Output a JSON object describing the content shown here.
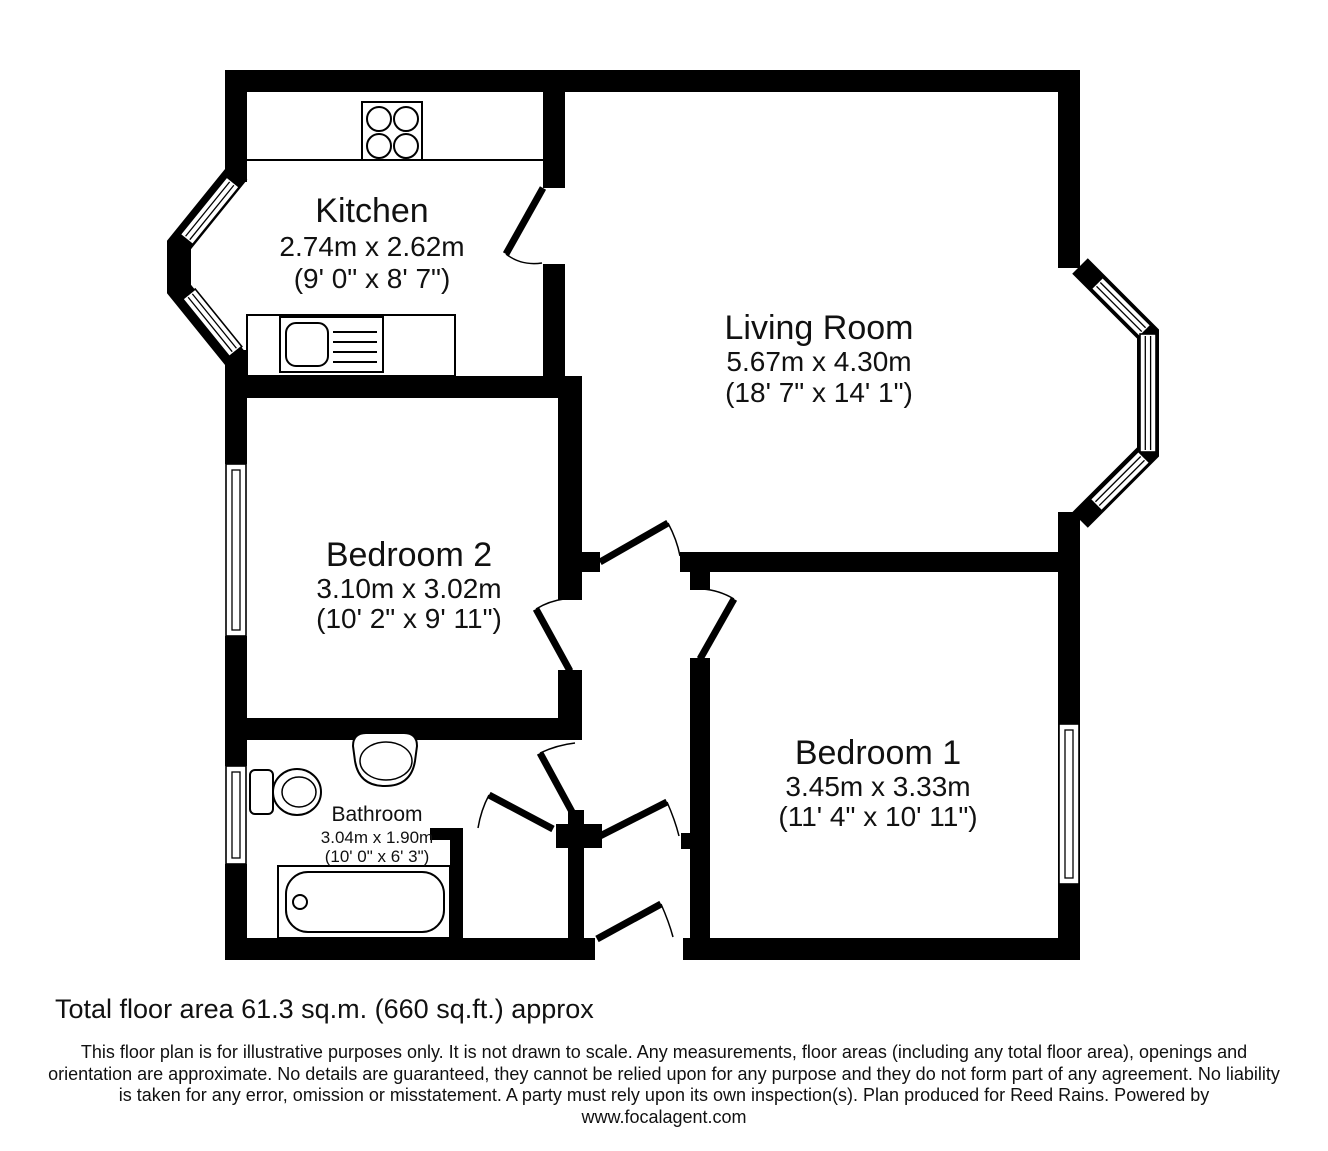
{
  "rooms": {
    "kitchen": {
      "name": "Kitchen",
      "metric": "2.74m x 2.62m",
      "imperial": "(9' 0\" x 8' 7\")"
    },
    "living_room": {
      "name": "Living Room",
      "metric": "5.67m x 4.30m",
      "imperial": "(18' 7\" x 14' 1\")"
    },
    "bedroom2": {
      "name": "Bedroom 2",
      "metric": "3.10m x 3.02m",
      "imperial": "(10' 2\" x 9' 11\")"
    },
    "bedroom1": {
      "name": "Bedroom 1",
      "metric": "3.45m x 3.33m",
      "imperial": "(11' 4\" x 10' 11\")"
    },
    "bathroom": {
      "name": "Bathroom",
      "metric": "3.04m x 1.90m",
      "imperial": "(10' 0\" x 6' 3\")"
    }
  },
  "footer": {
    "total_area": "Total floor area 61.3 sq.m. (660 sq.ft.) approx",
    "disclaimer": "This floor plan is for illustrative purposes only. It is not drawn to scale. Any measurements, floor areas (including any total floor area), openings and orientation are approximate. No details are guaranteed, they cannot be relied upon for any purpose and they do not form part of any agreement. No liability is taken for any error, omission or misstatement. A party must rely upon its own inspection(s). Plan produced for Reed Rains. Powered by",
    "website": "www.focalagent.com"
  },
  "colors": {
    "walls": "#000000",
    "background": "#ffffff"
  }
}
